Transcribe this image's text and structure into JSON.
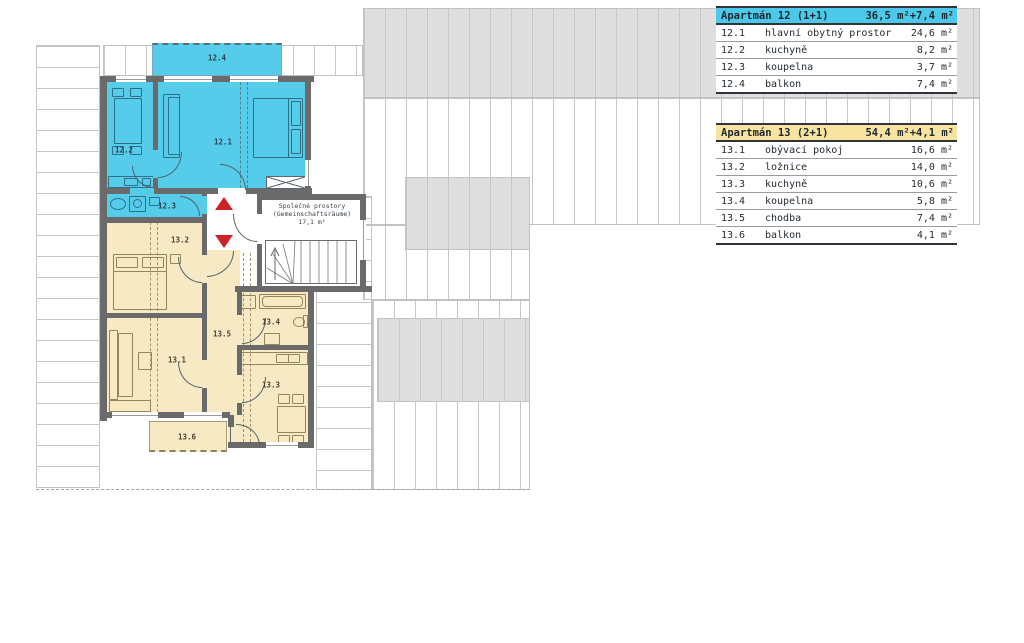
{
  "floor_plan": {
    "rooms": {
      "r12_1": "12.1",
      "r12_2": "12.2",
      "r12_3": "12.3",
      "r12_4": "12.4",
      "r13_1": "13.1",
      "r13_2": "13.2",
      "r13_3": "13.3",
      "r13_4": "13.4",
      "r13_5": "13.5",
      "r13_6": "13.6"
    },
    "common_area": {
      "line1": "Společné prostory",
      "line2": "(Gemeinschaftsräume)",
      "line3": "17,1 m²"
    }
  },
  "legend_tables": [
    {
      "title": "Apartmán 12 (1+1)",
      "total_area": "36,5 m²+7,4 m²",
      "header_color": "#4cc9e8",
      "rows": [
        {
          "num": "12.1",
          "name": "hlavní obytný prostor",
          "area": "24,6 m²"
        },
        {
          "num": "12.2",
          "name": "kuchyně",
          "area": "8,2 m²"
        },
        {
          "num": "12.3",
          "name": "koupelna",
          "area": "3,7 m²"
        },
        {
          "num": "12.4",
          "name": "balkon",
          "area": "7,4 m²"
        }
      ]
    },
    {
      "title": "Apartmán 13 (2+1)",
      "total_area": "54,4 m²+4,1 m²",
      "header_color": "#f8e3a1",
      "rows": [
        {
          "num": "13.1",
          "name": "obývací pokoj",
          "area": "16,6 m²"
        },
        {
          "num": "13.2",
          "name": "ložnice",
          "area": "14,0 m²"
        },
        {
          "num": "13.3",
          "name": "kuchyně",
          "area": "10,6 m²"
        },
        {
          "num": "13.4",
          "name": "koupelna",
          "area": "5,8 m²"
        },
        {
          "num": "13.5",
          "name": "chodba",
          "area": "7,4 m²"
        },
        {
          "num": "13.6",
          "name": "balkon",
          "area": "4,1 m²"
        }
      ]
    }
  ],
  "colors": {
    "apartment12_fill": "#55cce9",
    "apartment13_fill": "#f7e9c4",
    "wall": "#6a6a6a",
    "roof_shade": "#dedede",
    "stair_arrow_red": "#cf2128",
    "common_area_fill": "#ffffff"
  }
}
